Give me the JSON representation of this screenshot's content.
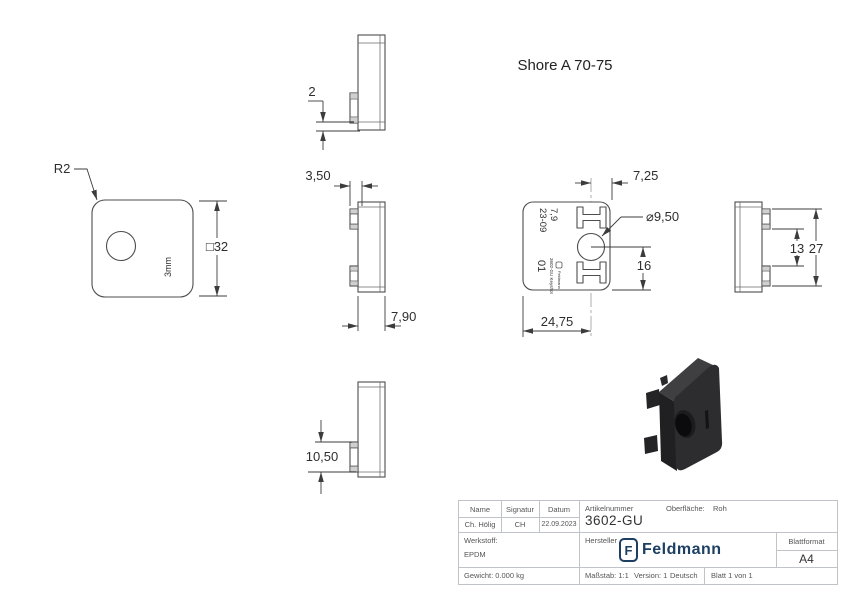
{
  "page": {
    "note_shore": "Shore A 70-75"
  },
  "views": {
    "front": {
      "radius_label": "R2",
      "size_label": "□32",
      "marking": "3mm"
    },
    "side_top": {
      "dim_lip": "2"
    },
    "side_mid": {
      "dim_boss_depth": "3,50",
      "dim_thickness": "7,90"
    },
    "side_bottom": {
      "dim_boss_length": "10,50"
    },
    "back": {
      "dim_center_to_edge": "7,25",
      "dim_hole": "⌀9,50",
      "dim_center_to_bottom": "16",
      "dim_edge_to_center": "24,75",
      "marking_shore": "7,9",
      "marking_date": "23-09",
      "marking_cavity": "01",
      "marking_article": "3602-GU Keyshot",
      "marking_brand": "Feldmann"
    },
    "side_right": {
      "dim_tab_gap": "13",
      "dim_tab_span": "27"
    }
  },
  "title_block": {
    "name_header": "Name",
    "signatur_header": "Signatur",
    "datum_header": "Datum",
    "name": "Ch. Hölig",
    "signatur": "CH",
    "datum": "22.09.2023",
    "artikelnummer_label": "Artikelnummer",
    "artikelnummer": "3602-GU",
    "oberflaeche_label": "Oberfläche:",
    "oberflaeche": "Roh",
    "werkstoff_label": "Werkstoff:",
    "werkstoff": "EPDM",
    "hersteller_label": "Hersteller",
    "logo_letter": "F",
    "logo_text": "Feldmann",
    "blattformat_label": "Blattformat",
    "blattformat": "A4",
    "gewicht": "Gewicht: 0.000 kg",
    "massstab": "Maßstab: 1:1",
    "version": "Version: 1",
    "sprache": "Deutsch",
    "blatt": "Blatt 1 von 1"
  },
  "colors": {
    "line": "#4d4d4d",
    "dim_text": "#2e2e2e",
    "logo_navy": "#1d3f63",
    "part_front": "#2d2d30",
    "part_top": "#3f3f42"
  }
}
